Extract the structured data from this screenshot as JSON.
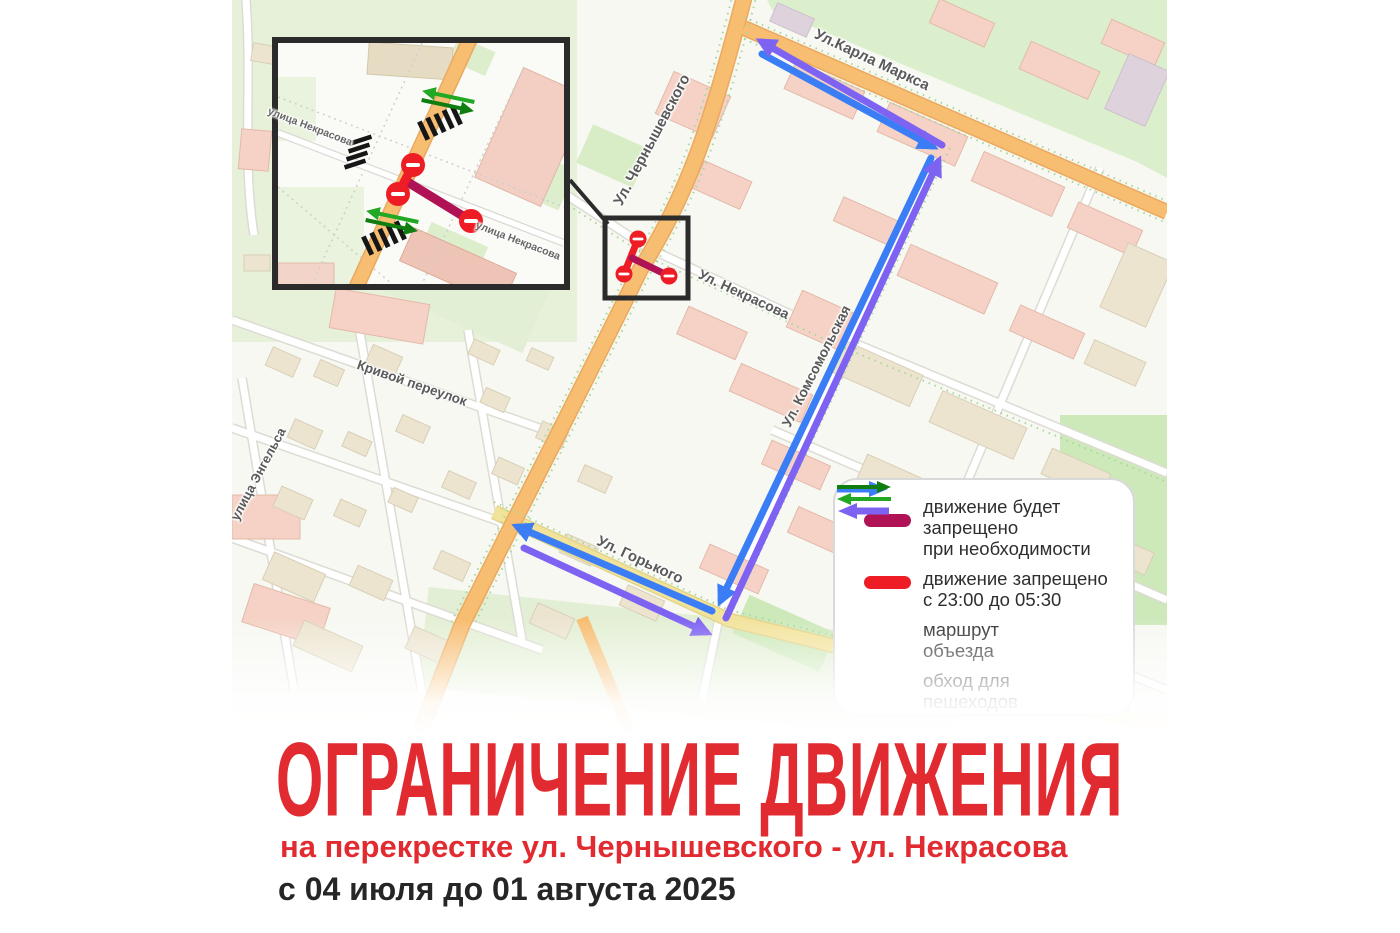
{
  "poster": {
    "title": "ОГРАНИЧЕНИЕ ДВИЖЕНИЯ",
    "subtitle": "на перекрестке ул. Чернышевского - ул. Некрасова",
    "date_range": "с 04 июля до 01 августа 2025"
  },
  "map": {
    "street_labels": {
      "chernyshevskogo": "Ул. Чернышевского",
      "karla_marksa": "Ул.Карла Маркса",
      "nekrasova": "Ул. Некрасова",
      "komsomolskaya": "Ул. Комсомольская",
      "gorkogo": "Ул. Горького",
      "krivoy_pereulok": "Кривой переулок",
      "engelsa": "улица Энгельса"
    },
    "inset": {
      "label_nekrasova_west": "улица Некрасова",
      "label_nekrasova_east": "улица Некрасова"
    },
    "colors": {
      "road_orange": "#f7bd71",
      "road_yellow": "#f2e39b",
      "route_blue": "#3b7df5",
      "route_purple": "#7e63f2",
      "restriction_red": "#ee1c25",
      "restriction_crimson": "#b01355",
      "pedestrian_green_dark": "#0f7d0f",
      "pedestrian_green_light": "#22a822",
      "title_red": "#e12b31"
    }
  },
  "legend": {
    "items": [
      {
        "symbol": "crimson-bar",
        "lines": [
          "движение будет",
          "запрещено",
          "при необходимости"
        ]
      },
      {
        "symbol": "red-bar",
        "lines": [
          "движение запрещено",
          "с 23:00 до 05:30"
        ]
      },
      {
        "symbol": "blue-purple-arrows",
        "lines": [
          "маршрут",
          "объезда"
        ]
      },
      {
        "symbol": "green-arrows",
        "lines": [
          "обход для",
          "пешеходов"
        ]
      }
    ]
  }
}
